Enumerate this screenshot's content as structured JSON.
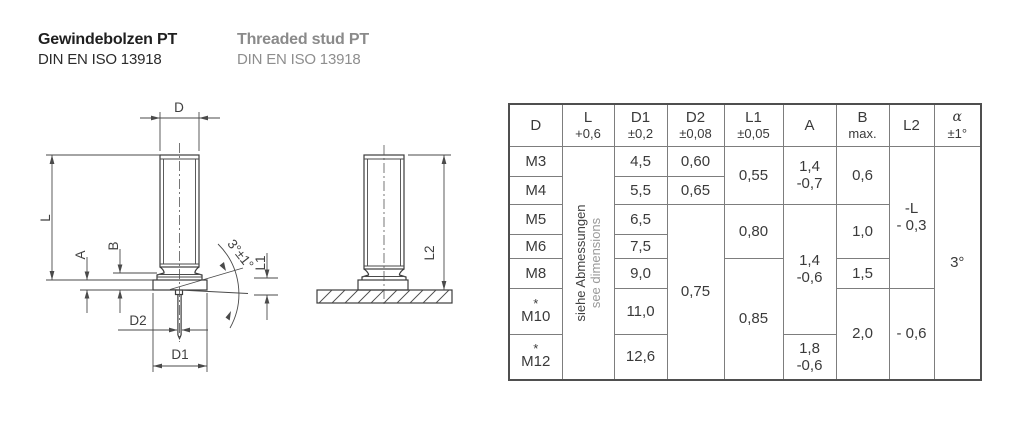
{
  "header": {
    "de": {
      "title": "Gewindebolzen PT",
      "standard": "DIN EN ISO 13918"
    },
    "en": {
      "title": "Threaded stud PT",
      "standard": "DIN EN ISO 13918"
    }
  },
  "drawing": {
    "front": {
      "d": "D",
      "l": "L",
      "a": "A",
      "b": "B",
      "d2": "D2",
      "d1": "D1",
      "angle": "3°±1°",
      "l1": "L1"
    },
    "side": {
      "l2": "L2"
    }
  },
  "table": {
    "headers": [
      {
        "main": "D",
        "sub": ""
      },
      {
        "main": "L",
        "sub": "+0,6"
      },
      {
        "main": "D1",
        "sub": "±0,2"
      },
      {
        "main": "D2",
        "sub": "±0,08"
      },
      {
        "main": "L1",
        "sub": "±0,05"
      },
      {
        "main": "A",
        "sub": ""
      },
      {
        "main": "B",
        "sub": "max."
      },
      {
        "main": "L2",
        "sub": ""
      },
      {
        "main": "α",
        "sub": "±1°"
      }
    ],
    "note": {
      "de": "siehe Abmessungen",
      "en": "see dimensions"
    },
    "cells": {
      "star": "*",
      "d_m3": "M3",
      "d_m4": "M4",
      "d_m5": "M5",
      "d_m6": "M6",
      "d_m8": "M8",
      "d_m10": "M10",
      "d_m12": "M12",
      "d1_m3": "4,5",
      "d1_m4": "5,5",
      "d1_m5": "6,5",
      "d1_m6": "7,5",
      "d1_m8": "9,0",
      "d1_m10": "11,0",
      "d1_m12": "12,6",
      "d2_m3": "0,60",
      "d2_m4": "0,65",
      "d2_m5_m12": "0,75",
      "l1_m3_m4": "0,55",
      "l1_m5_m6": "0,80",
      "l1_m8_m12": "0,85",
      "a_m3_m4": "1,4\n-0,7",
      "a_m5_m10": "1,4\n-0,6",
      "a_m12": "1,8\n-0,6",
      "b_m3_m4": "0,6",
      "b_m5_m6": "1,0",
      "b_m8": "1,5",
      "b_m10_m12": "2,0",
      "l2_m3_m8": "-L\n- 0,3",
      "l2_m10_m12": "- 0,6",
      "alpha_all": "3°"
    }
  }
}
